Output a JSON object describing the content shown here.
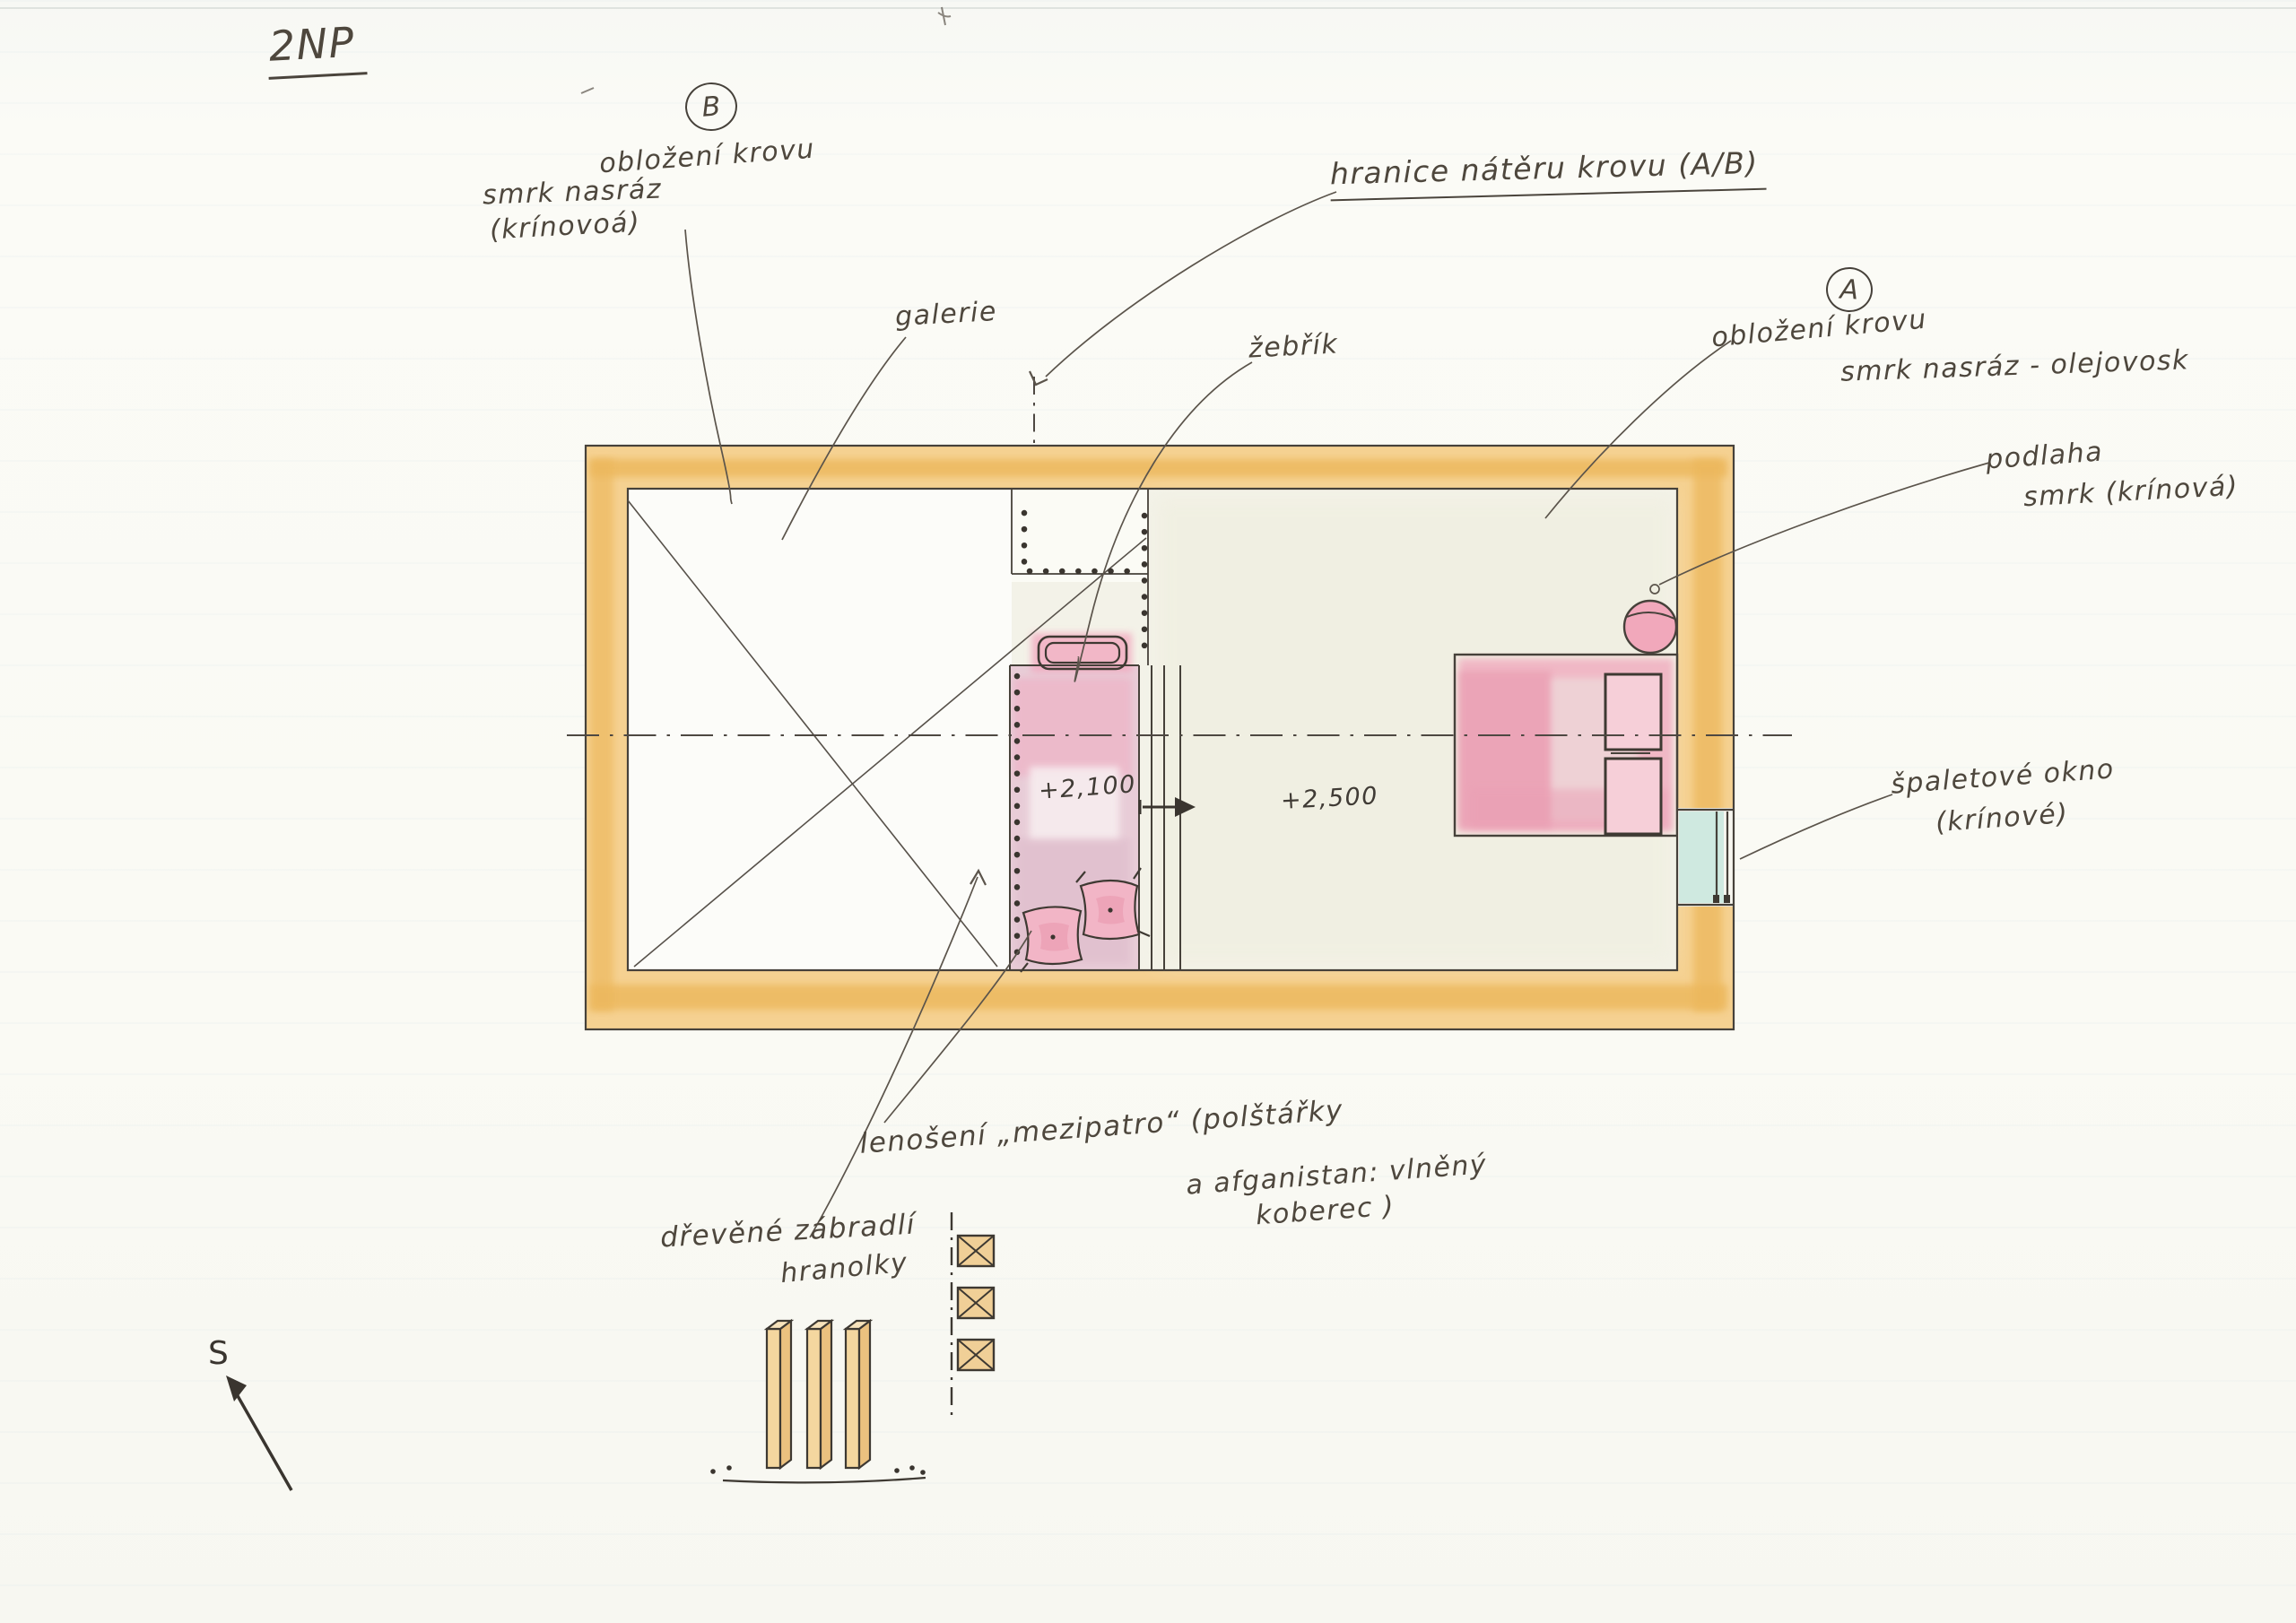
{
  "title": "2NP",
  "north_label": "S",
  "levels": {
    "mezzanine": "+2,100",
    "main_room": "+2,500"
  },
  "notes": {
    "b_marker": "B",
    "b_line1": "obložení krovu",
    "b_line2": "smrk nasráz",
    "b_line3": "(krínovoá)",
    "galerie": "galerie",
    "zebrik": "žebřík",
    "hranice": "hranice nátěru krovu (A/B)",
    "a_marker": "A",
    "a_line1": "obložení krovu",
    "a_line2": "smrk nasráz - olejovosk",
    "podlaha_line1": "podlaha",
    "podlaha_line2": "smrk (krínová)",
    "okno_line1": "špaletové okno",
    "okno_line2": "(krínové)",
    "lenoseni_line1": "lenošení „mezipatro“ (polštářky",
    "lenoseni_line2": "a afganistan: vlněný",
    "lenoseni_line3": "koberec )",
    "zabradli_line1": "dřevěné zábradlí",
    "zabradli_line2": "hranolky"
  },
  "colors": {
    "wall_orange": "#f5d191",
    "wall_core": "#ecb75c",
    "mezzanine_pink": "#e8ccd7",
    "bed_pink": "#f1b6c4",
    "window_teal": "#cfe9e0",
    "ink": "#46413a"
  }
}
